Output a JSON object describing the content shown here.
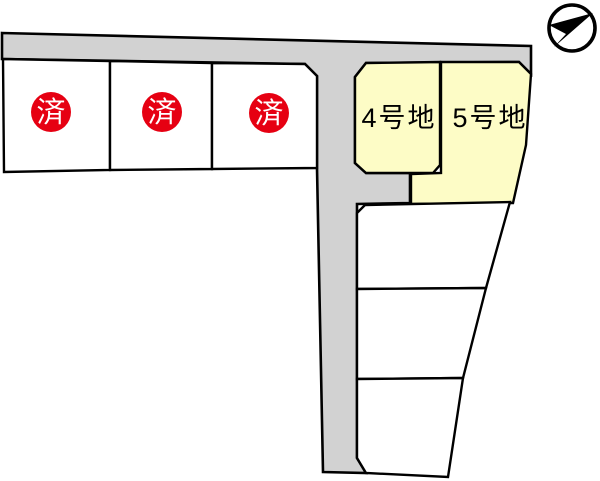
{
  "map": {
    "type": "residential-lot-plan"
  },
  "colors": {
    "background": "#ffffff",
    "outline": "#000000",
    "road_fill": "#d2d2d2",
    "vacant_fill": "#ffffff",
    "available_fill": "#fdfcc6",
    "sold_badge_fill": "#e60012",
    "sold_badge_text": "#ffffff",
    "label_text": "#000000"
  },
  "lots": {
    "sold": [
      {
        "label": "済"
      },
      {
        "label": "済"
      },
      {
        "label": "済"
      }
    ],
    "available": [
      {
        "label": "4号地"
      },
      {
        "label": "5号地"
      }
    ],
    "unlabeled_count": 3
  },
  "compass": {
    "icon": "north-arrow"
  }
}
